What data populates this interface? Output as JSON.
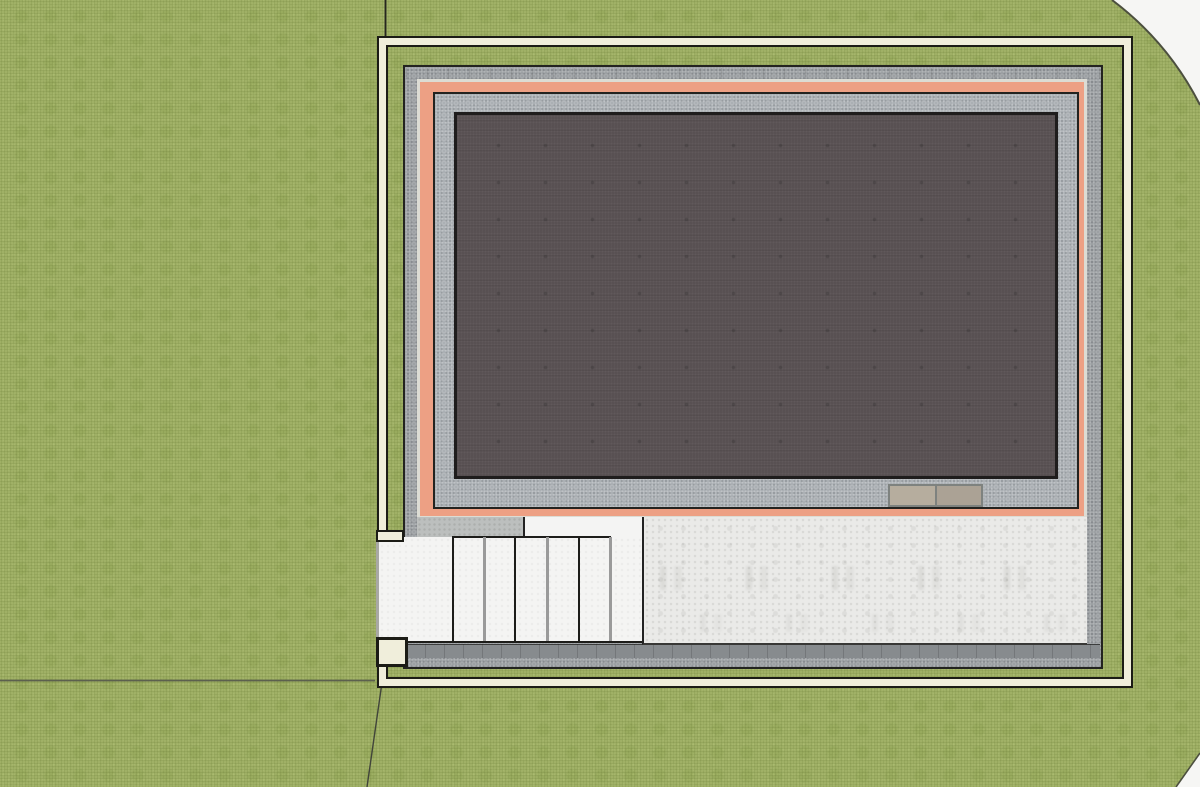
{
  "meta": {
    "view": "top-down architectural site plan",
    "canvas_width": 1200,
    "canvas_height": 787,
    "visible_text": "none"
  },
  "colors": {
    "paper": "#f6f6f4",
    "grass": "#a3b469",
    "grass_outline": "#4c4f3e",
    "boundary_fill": "#f0eedb",
    "boundary_stroke": "#1c1c16",
    "wall_gray": "#9b9fa2",
    "wall_bottom_gray": "#878b8e",
    "edge_black": "#232320",
    "trim_light": "#dcdcd4",
    "insulation_salmon": "#eda084",
    "inner_band_gray": "#a9aeb2",
    "roof_dark": "#575052",
    "stair_white": "#f4f4f3",
    "stair_line_gray": "#9a9a9a",
    "sill_gray": "#bcbfbe",
    "patio_concrete": "#eaeae8",
    "mat_tan_left": "#b6ad9e",
    "mat_tan_right": "#aba295",
    "mat_border": "#7e827f",
    "terrain_line": "#5c604e"
  },
  "stairs": {
    "tread_count": 7,
    "step_lines": [
      {
        "x": 452,
        "tone": "black"
      },
      {
        "x": 483,
        "tone": "gray"
      },
      {
        "x": 514,
        "tone": "black"
      },
      {
        "x": 546,
        "tone": "gray"
      },
      {
        "x": 578,
        "tone": "black"
      },
      {
        "x": 609,
        "tone": "gray"
      }
    ]
  },
  "doormat": {
    "cells": 2
  }
}
